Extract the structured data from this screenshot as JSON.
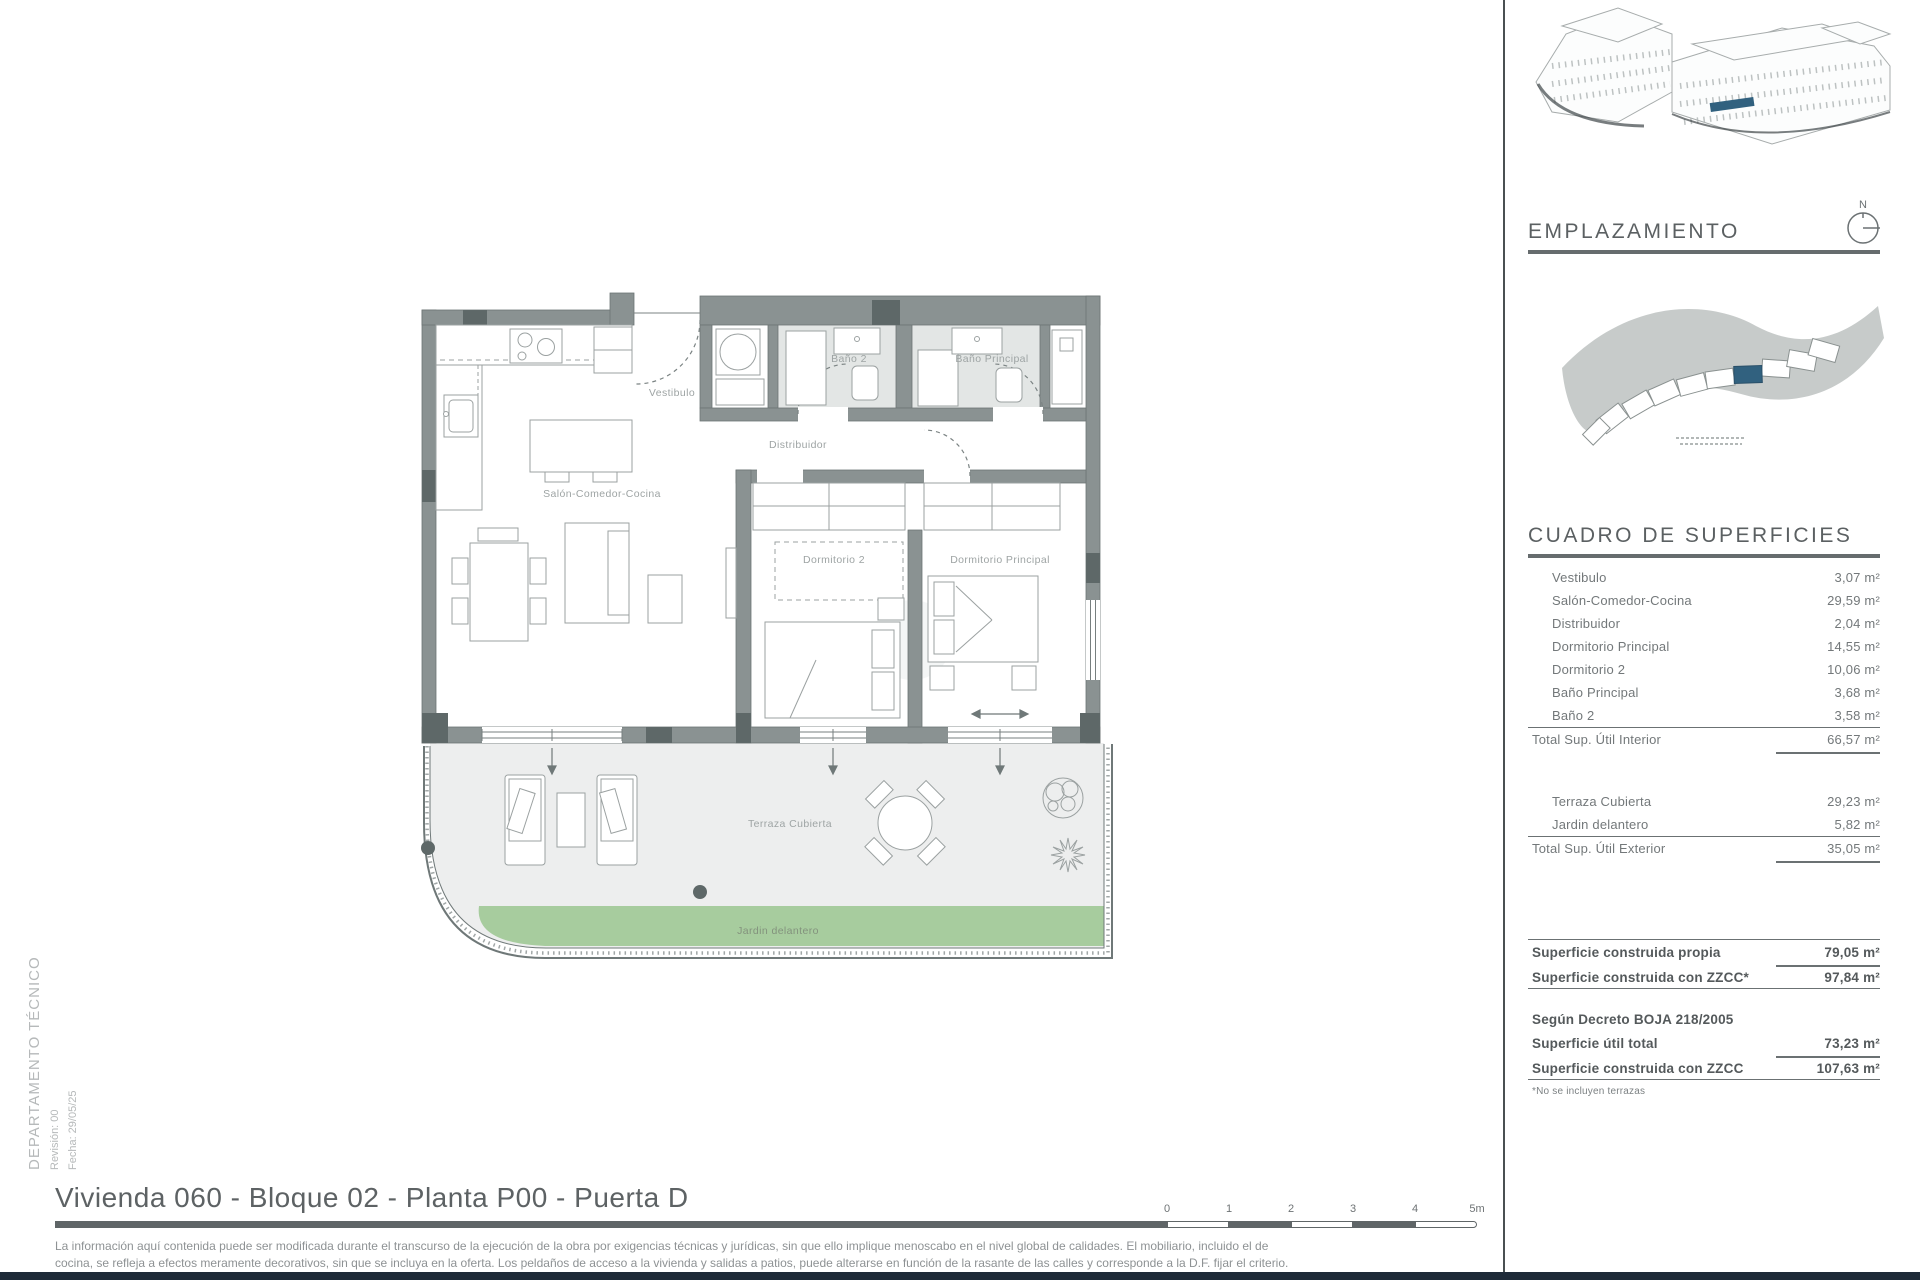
{
  "theme": {
    "wall_color": "#8A9292",
    "wall_dark": "#5E6868",
    "bath_floor": "#E3E6E5",
    "terrace_floor": "#EDEEEE",
    "garden_green": "#A7CC9E",
    "highlight_blue": "#31617F",
    "footer_bar": "#1E2A38"
  },
  "plan": {
    "rooms": {
      "vestibulo": "Vestibulo",
      "salon": "Salón-Comedor-Cocina",
      "distribuidor": "Distribuidor",
      "bano2": "Baño 2",
      "banop": "Baño Principal",
      "dorm2": "Dormitorio 2",
      "dormp": "Dormitorio Principal",
      "terraza": "Terraza Cubierta",
      "jardin": "Jardin delantero"
    }
  },
  "sidebar": {
    "emplazamiento_title": "EMPLAZAMIENTO",
    "compass_label": "N",
    "superficies_title": "CUADRO DE SUPERFICIES",
    "rows": [
      {
        "label": "Vestibulo",
        "value": "3,07 m²"
      },
      {
        "label": "Salón-Comedor-Cocina",
        "value": "29,59 m²"
      },
      {
        "label": "Distribuidor",
        "value": "2,04 m²"
      },
      {
        "label": "Dormitorio Principal",
        "value": "14,55 m²"
      },
      {
        "label": "Dormitorio 2",
        "value": "10,06 m²"
      },
      {
        "label": "Baño Principal",
        "value": "3,68 m²"
      },
      {
        "label": "Baño 2",
        "value": "3,58 m²"
      }
    ],
    "total_interior": {
      "label": "Total Sup. Útil Interior",
      "value": "66,57 m²"
    },
    "exterior_rows": [
      {
        "label": "Terraza Cubierta",
        "value": "29,23 m²"
      },
      {
        "label": "Jardin delantero",
        "value": "5,82 m²"
      }
    ],
    "total_exterior": {
      "label": "Total Sup. Útil Exterior",
      "value": "35,05 m²"
    },
    "construida_rows": [
      {
        "label": "Superficie construida propia",
        "value": "79,05 m²"
      },
      {
        "label": "Superficie construida con ZZCC*",
        "value": "97,84 m²"
      }
    ],
    "decreto_heading": "Según Decreto BOJA 218/2005",
    "decreto_rows": [
      {
        "label": "Superficie útil total",
        "value": "73,23 m²"
      },
      {
        "label": "Superficie construida con ZZCC",
        "value": "107,63 m²"
      }
    ],
    "footnote": "*No se incluyen terrazas"
  },
  "footer": {
    "title": "Vivienda 060 - Bloque 02 - Planta P00 - Puerta D",
    "department": "DEPARTAMENTO TÉCNICO",
    "revision": "Revisión: 00",
    "date": "Fecha: 29/05/25",
    "disclaimer_line1": "La información aquí contenida puede ser modificada durante el transcurso de la ejecución de la obra por exigencias técnicas y jurídicas, sin que ello implique menoscabo en el nivel global de calidades. El mobiliario, incluido el de",
    "disclaimer_line2": "cocina, se refleja a efectos meramente decorativos, sin que se incluya en la oferta. Los peldaños de acceso a la vivienda y salidas a patios, puede alterarse en función de la rasante de las calles y corresponde a la D.F. fijar el criterio.",
    "scale_labels": [
      "0",
      "1",
      "2",
      "3",
      "4",
      "5m"
    ]
  }
}
